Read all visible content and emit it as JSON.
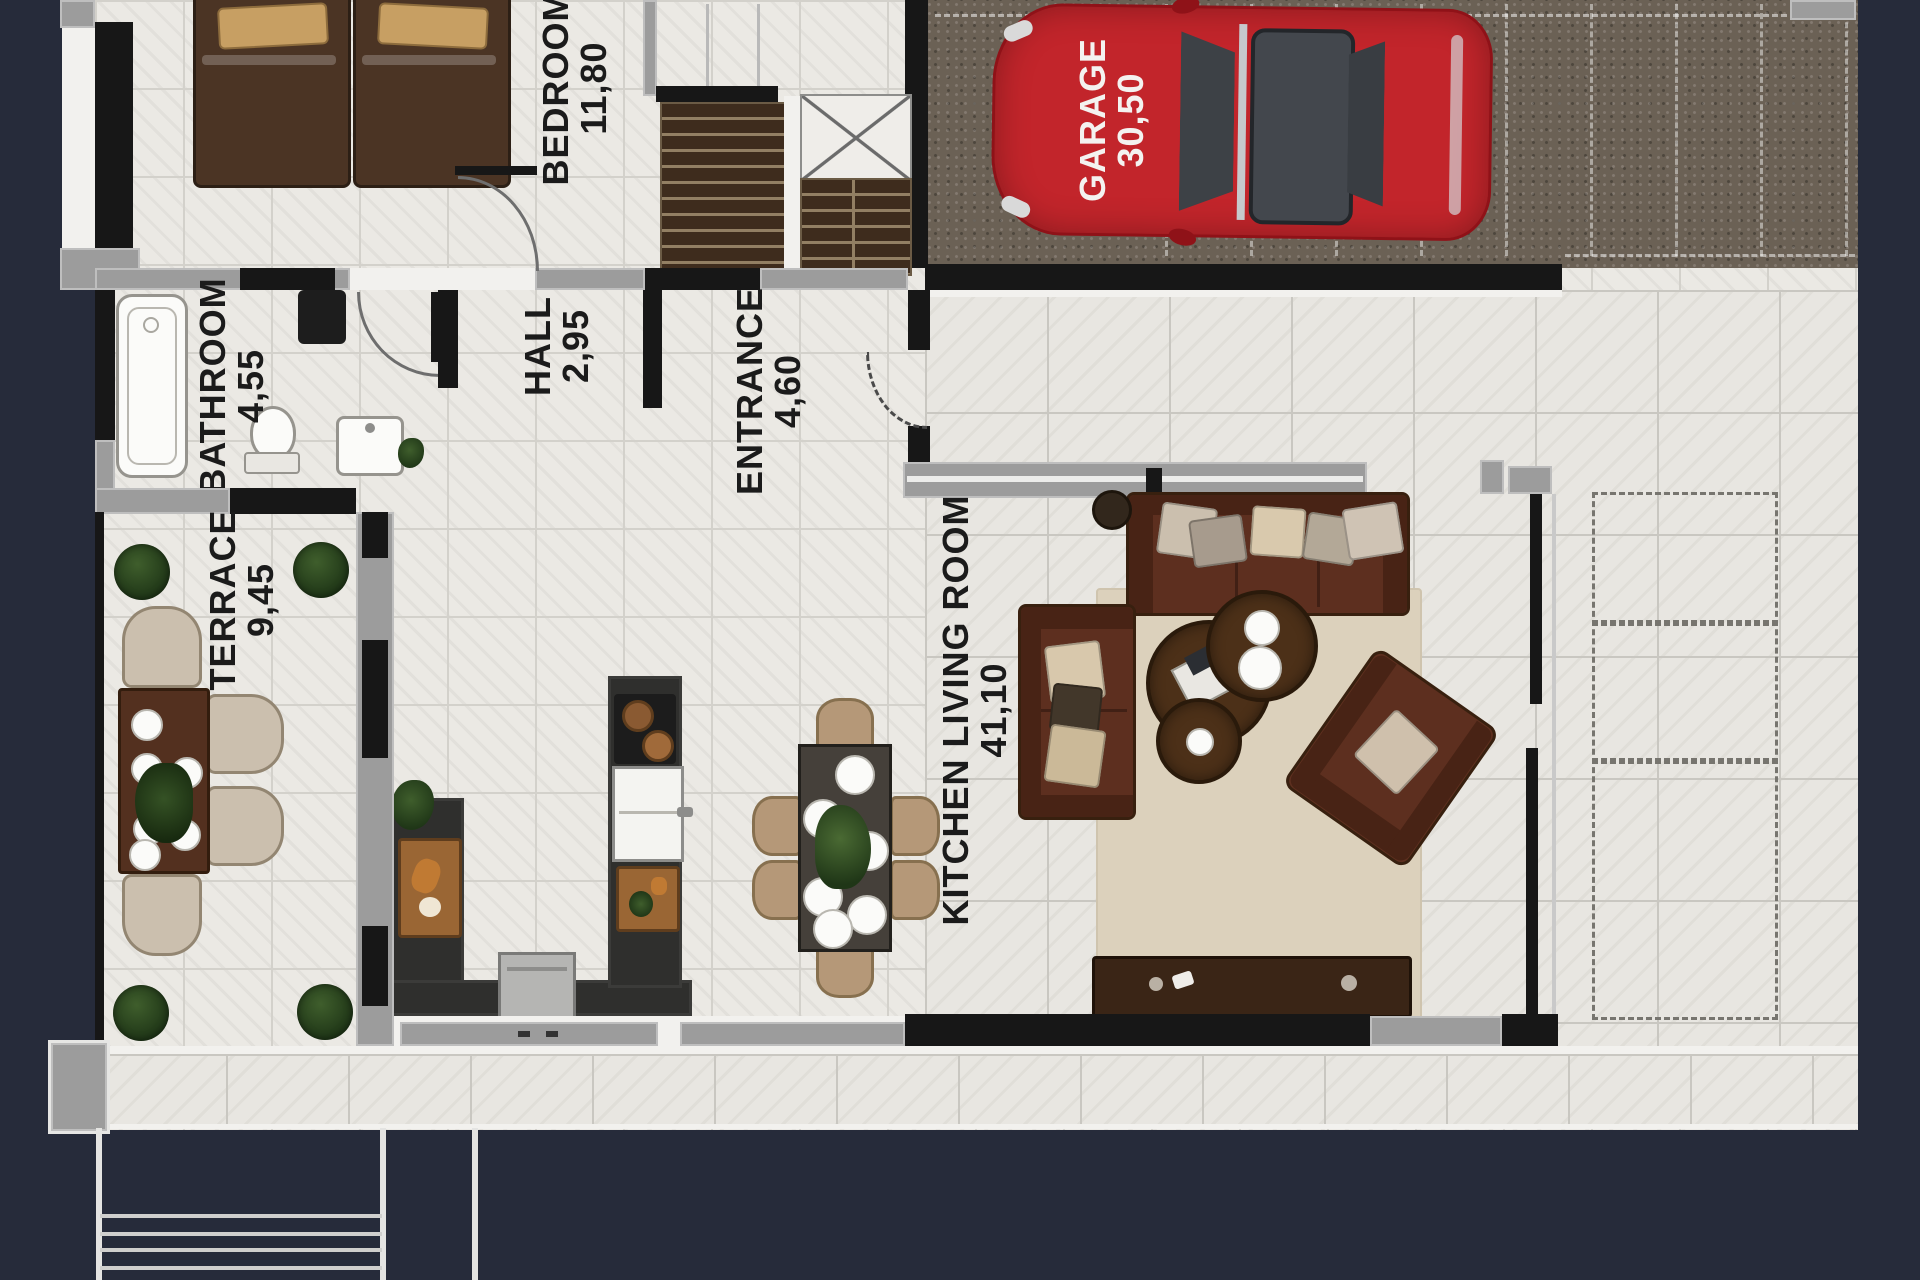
{
  "title": "house-ground-floor-plan",
  "rooms": {
    "bedroom": {
      "name": "BEDROOM",
      "area": "11,80"
    },
    "bathroom": {
      "name": "BATHROOM",
      "area": "4,55"
    },
    "hall": {
      "name": "HALL",
      "area": "2,95"
    },
    "entrance": {
      "name": "ENTRANCE",
      "area": "4,60"
    },
    "terrace": {
      "name": "TERRACE",
      "area": "9,45"
    },
    "kitchen_living_room": {
      "name": "KITCHEN LIVING ROOM",
      "area": "41,10"
    },
    "garage": {
      "name": "GARAGE",
      "area": "30,50"
    }
  },
  "colors": {
    "background": "#262b3a",
    "wall_black": "#171717",
    "wall_gray": "#9c9c9c",
    "floor_tile": "#ebe9e4",
    "garage_floor": "#6b6155",
    "car_red": "#c2252b",
    "sofa_brown": "#5d2f1f",
    "rug_beige": "#dcd1bc",
    "plant_green": "#2c4a21",
    "chair_tan": "#b59878"
  }
}
